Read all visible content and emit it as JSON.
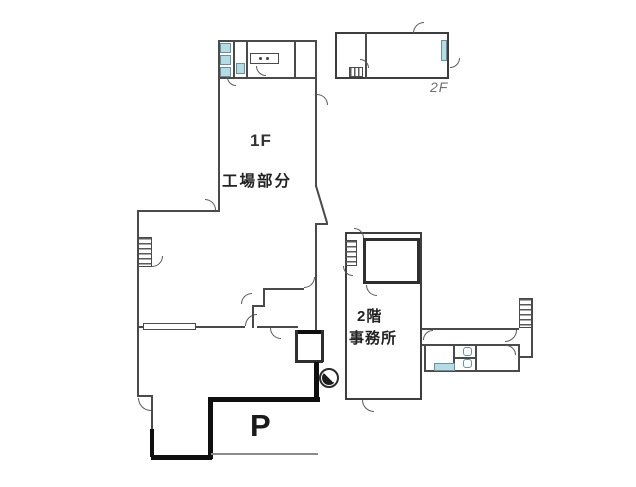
{
  "document": {
    "type": "floor-plan",
    "background": "#ffffff"
  },
  "colors": {
    "wall": "#4a4a4a",
    "inner_wall": "#2f2f2f",
    "site_boundary": "#0f0f0f",
    "fixture_fill": "#b5dbe4",
    "ground_line": "#8c8c8c",
    "text_dark": "#222222",
    "text_gray": "#707070"
  },
  "labels": {
    "first_floor": {
      "floor": "1F",
      "name": "工場部分"
    },
    "office": {
      "floor": "2階",
      "name": "事務所"
    },
    "second_floor_annex": {
      "floor": "2F"
    },
    "parking": {
      "mark": "P"
    }
  },
  "icons": {
    "stairs": "hatched-rectangle",
    "door": "quarter-circle-arc",
    "toilet": "small-blue-square",
    "sink_counter": "rectangle-with-two-dots",
    "window": "double-line-rectangle",
    "utility_pole": "circle-half-filled"
  }
}
